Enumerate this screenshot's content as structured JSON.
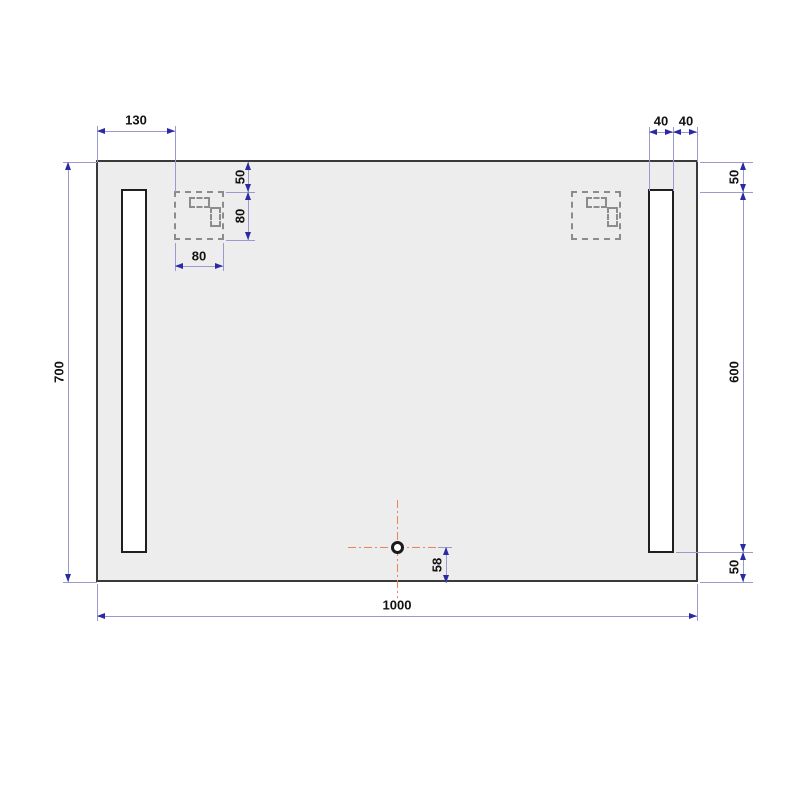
{
  "drawing": {
    "name": "led-mirror-technical-drawing",
    "units_hint": "mm"
  },
  "dims": {
    "bracket_offset_left": "130",
    "strip_width": "40",
    "strip_edge_gap": "40",
    "overall_height": "700",
    "overall_width": "1000",
    "bracket_top_gap": "50",
    "bracket_height": "80",
    "bracket_width": "80",
    "strip_top_gap": "50",
    "strip_length": "600",
    "strip_bottom_gap": "50",
    "sensor_bottom_offset": "58"
  },
  "colors": {
    "dimension_line": "#9a9ad0",
    "dimension_arrow": "#2a2aa5",
    "mirror_outline": "#3a3a3a",
    "mirror_fill": "#ededee",
    "bracket_dash": "#8c8c8c",
    "centerline_red": "#e8825f",
    "label_text": "#111111"
  }
}
